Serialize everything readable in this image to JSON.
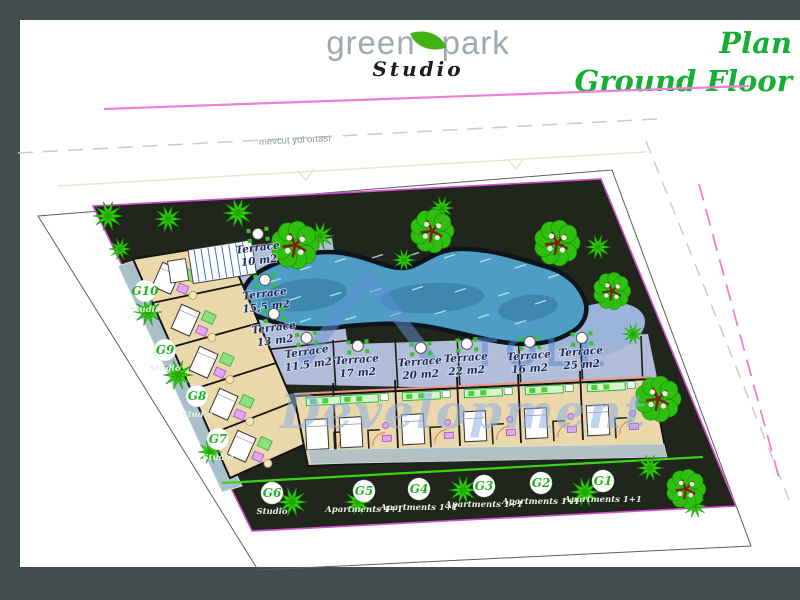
{
  "header": {
    "logo": {
      "word1": "green",
      "word2": "park",
      "subtitle": "Studio"
    },
    "title": {
      "line1": "Plan",
      "line2": "Ground Floor"
    }
  },
  "plan": {
    "road_center_label": "mevcut yol ortası",
    "watermark": {
      "logo_text": "TOLL",
      "script_text": "Development"
    },
    "terraces": [
      {
        "name": "Terrace",
        "area": "10 m2"
      },
      {
        "name": "Terrace",
        "area": "15,5 m2"
      },
      {
        "name": "Terrace",
        "area": "13 m2"
      },
      {
        "name": "Terrace",
        "area": "11.5 m2"
      },
      {
        "name": "Terrace",
        "area": "17 m2"
      },
      {
        "name": "Terrace",
        "area": "20 m2"
      },
      {
        "name": "Terrace",
        "area": "22 m2"
      },
      {
        "name": "Terrace",
        "area": "16 m2"
      },
      {
        "name": "Terrace",
        "area": "25 m2"
      }
    ],
    "units": [
      {
        "id": "G10",
        "type": "Studio"
      },
      {
        "id": "G9",
        "type": "Studio"
      },
      {
        "id": "G8",
        "type": "Studio"
      },
      {
        "id": "G7",
        "type": "Studio"
      },
      {
        "id": "G6",
        "type": "Studio"
      },
      {
        "id": "G5",
        "type": "Apartments 1+1"
      },
      {
        "id": "G4",
        "type": "Apartments 1+1"
      },
      {
        "id": "G3",
        "type": "Apartments 1+1"
      },
      {
        "id": "G2",
        "type": "Apartments 1+1"
      },
      {
        "id": "G1",
        "type": "Apartments 1+1"
      }
    ]
  },
  "colors": {
    "frame_slate": "#424d4e",
    "title_green": "#17ae35",
    "logo_gray": "#9fa9b1",
    "leaf_green": "#44b216",
    "road_magenta": "#ed7fd8",
    "plot_dark": "#20261b",
    "plot_outline_magenta": "#d052cc",
    "pool_blue": "#4d9dc4",
    "terrace_periwinkle": "#b2bdd9",
    "building_beige": "#ead8aa",
    "tree_green": "#2fd40a",
    "badge_green": "#1db51d",
    "watermark_blue": "#5e8ed6"
  }
}
